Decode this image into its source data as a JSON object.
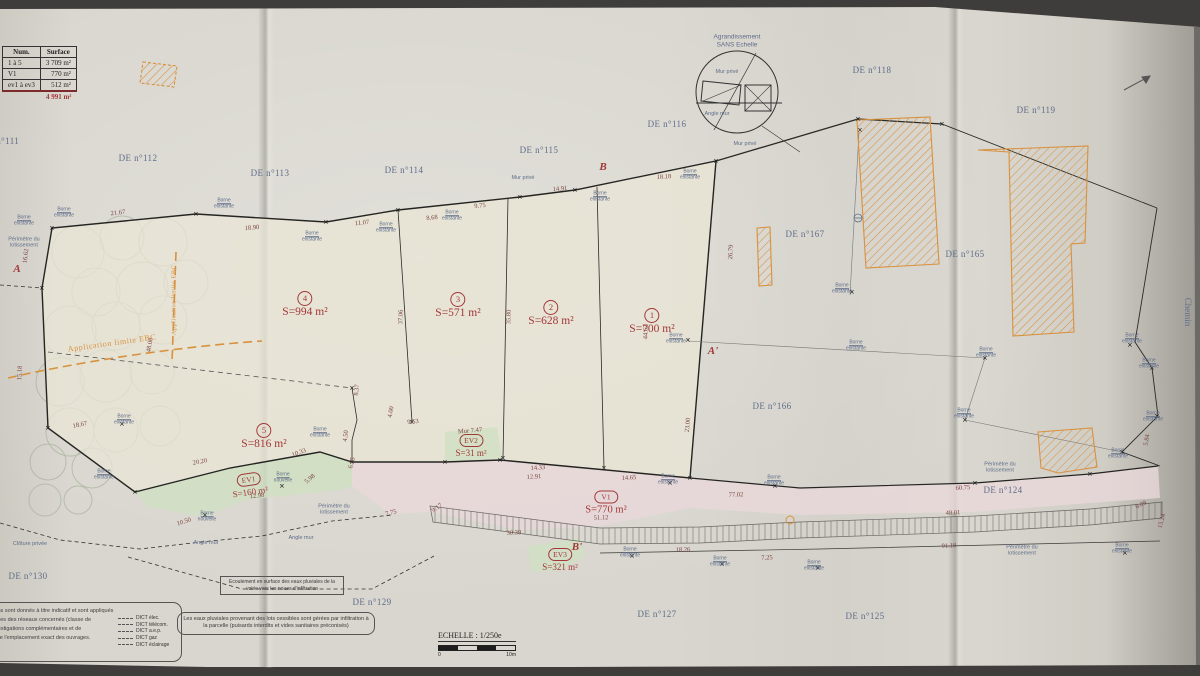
{
  "colors": {
    "paper": "#d6d4cc",
    "line": "#2a2a28",
    "blue": "#5f6d8a",
    "red": "#a33838",
    "orange": "#d8913f",
    "green_fill": "#cfe0c2",
    "pink_fill": "#e9d8da",
    "tree": "#9aa98e"
  },
  "summary_table": {
    "headers": [
      "Num.",
      "Surface"
    ],
    "rows": [
      [
        "1 à 5",
        "3 709 m²"
      ],
      [
        "V1",
        "770 m²"
      ],
      [
        "ev1 à ev3",
        "512 m²"
      ]
    ],
    "total": "4 991 m²"
  },
  "detail_circle": {
    "line1": "Agrandissement",
    "line2": "SANS Echelle"
  },
  "scale": {
    "label": "ECHELLE : 1/250e",
    "start": "0",
    "end": "10m"
  },
  "notes": {
    "flow": "Ecoulement en surface des eaux pluviales de la voirie vers les noues d'infiltration",
    "rain": "Les eaux pluviales provenant des lots cessibles sont gérées par infiltration à la parcelle (puisards interdits et vides sanitaires préconisés)",
    "left_paragraph": [
      "réseaux souterrains sont donnés à titre indicatif et sont appliqués",
      "les concessionnaires des réseaux concernés (classe de",
      "de réaliser les investigations complémentaires et de",
      "afin de s'assurer de l'emplacement exact des ouvrages."
    ],
    "dict_items": [
      "DICT élec.",
      "DICT télécom.",
      "DICT a.e.p.",
      "DICT gaz",
      "DICT éclairage"
    ]
  },
  "labels": {
    "parcels": [
      {
        "t": "DE n°111",
        "x": 0,
        "y": 141
      },
      {
        "t": "DE n°112",
        "x": 138,
        "y": 158
      },
      {
        "t": "DE n°113",
        "x": 270,
        "y": 173
      },
      {
        "t": "DE n°114",
        "x": 404,
        "y": 170
      },
      {
        "t": "DE n°115",
        "x": 539,
        "y": 150
      },
      {
        "t": "DE n°116",
        "x": 667,
        "y": 124
      },
      {
        "t": "DE n°118",
        "x": 872,
        "y": 70
      },
      {
        "t": "DE n°119",
        "x": 1036,
        "y": 110
      },
      {
        "t": "DE n°167",
        "x": 805,
        "y": 234
      },
      {
        "t": "DE n°165",
        "x": 965,
        "y": 254
      },
      {
        "t": "DE n°166",
        "x": 772,
        "y": 406
      },
      {
        "t": "DE n°124",
        "x": 1003,
        "y": 490
      },
      {
        "t": "DE n°125",
        "x": 865,
        "y": 616
      },
      {
        "t": "DE n°127",
        "x": 657,
        "y": 614
      },
      {
        "t": "DE n°129",
        "x": 372,
        "y": 602
      },
      {
        "t": "DE n°130",
        "x": 28,
        "y": 576
      }
    ],
    "lots": [
      {
        "id": "4",
        "area": "S=994 m²",
        "x": 305,
        "y": 303,
        "shape": "circle",
        "cls": ""
      },
      {
        "id": "3",
        "area": "S=571 m²",
        "x": 458,
        "y": 304,
        "shape": "circle",
        "cls": ""
      },
      {
        "id": "2",
        "area": "S=628 m²",
        "x": 551,
        "y": 312,
        "shape": "circle",
        "cls": ""
      },
      {
        "id": "1",
        "area": "S=700 m²",
        "x": 652,
        "y": 320,
        "shape": "circle",
        "cls": ""
      },
      {
        "id": "5",
        "area": "S=816 m²",
        "x": 264,
        "y": 435,
        "shape": "circle",
        "cls": ""
      },
      {
        "id": "V1",
        "area": "S=770 m²",
        "x": 606,
        "y": 501,
        "shape": "oval",
        "cls": "mid"
      },
      {
        "id": "EV2",
        "area": "S=31 m²",
        "x": 471,
        "y": 444,
        "shape": "oval",
        "cls": "small"
      },
      {
        "id": "EV1",
        "area": "S=160 m²",
        "x": 249,
        "y": 483,
        "shape": "oval",
        "cls": "small",
        "r": -8
      },
      {
        "id": "EV3",
        "area": "S=321 m²",
        "x": 560,
        "y": 558,
        "shape": "oval",
        "cls": "small"
      }
    ],
    "sections": [
      {
        "t": "A",
        "x": 17,
        "y": 269
      },
      {
        "t": "A'",
        "x": 713,
        "y": 351
      },
      {
        "t": "B",
        "x": 603,
        "y": 167
      },
      {
        "t": "B'",
        "x": 577,
        "y": 547
      }
    ],
    "measurements": [
      {
        "t": "21.67",
        "x": 118,
        "y": 213,
        "r": -7
      },
      {
        "t": "18.90",
        "x": 252,
        "y": 228,
        "r": -5
      },
      {
        "t": "11.07",
        "x": 362,
        "y": 223,
        "r": -6
      },
      {
        "t": "8.68",
        "x": 432,
        "y": 218,
        "r": -6
      },
      {
        "t": "9.75",
        "x": 480,
        "y": 206,
        "r": -6
      },
      {
        "t": "14.91",
        "x": 560,
        "y": 189,
        "r": -5
      },
      {
        "t": "18.18",
        "x": 664,
        "y": 177,
        "r": -3
      },
      {
        "t": "16.62",
        "x": 26,
        "y": 256,
        "r": -83
      },
      {
        "t": "15.18",
        "x": 20,
        "y": 373,
        "r": -87
      },
      {
        "t": "48.08",
        "x": 150,
        "y": 345,
        "r": -80
      },
      {
        "t": "18.67",
        "x": 80,
        "y": 425,
        "r": -12
      },
      {
        "t": "20.20",
        "x": 200,
        "y": 462,
        "r": -10
      },
      {
        "t": "10.50",
        "x": 184,
        "y": 522,
        "r": -18
      },
      {
        "t": "10.33",
        "x": 299,
        "y": 453,
        "r": -20
      },
      {
        "t": "12.98",
        "x": 257,
        "y": 496,
        "r": -6
      },
      {
        "t": "5.98",
        "x": 310,
        "y": 479,
        "r": -40
      },
      {
        "t": "6.55",
        "x": 352,
        "y": 463,
        "r": -75
      },
      {
        "t": "4.50",
        "x": 346,
        "y": 436,
        "r": -83
      },
      {
        "t": "8.37",
        "x": 357,
        "y": 390,
        "r": -85
      },
      {
        "t": "4.00",
        "x": 391,
        "y": 412,
        "r": -80
      },
      {
        "t": "9.53",
        "x": 413,
        "y": 422,
        "r": -6
      },
      {
        "t": "Mur 7.47",
        "x": 470,
        "y": 431,
        "r": -5
      },
      {
        "t": "14.33",
        "x": 538,
        "y": 468,
        "r": -4
      },
      {
        "t": "12.91",
        "x": 534,
        "y": 477,
        "r": -4
      },
      {
        "t": "14.65",
        "x": 629,
        "y": 478,
        "r": -3
      },
      {
        "t": "23.00",
        "x": 688,
        "y": 425,
        "r": -85
      },
      {
        "t": "44.62",
        "x": 646,
        "y": 332,
        "r": -88
      },
      {
        "t": "35.80",
        "x": 509,
        "y": 317,
        "r": -88
      },
      {
        "t": "37.06",
        "x": 401,
        "y": 317,
        "r": -88
      },
      {
        "t": "26.79",
        "x": 731,
        "y": 252,
        "r": -87
      },
      {
        "t": "51.12",
        "x": 601,
        "y": 518,
        "r": -2
      },
      {
        "t": "30.39",
        "x": 514,
        "y": 533,
        "r": -4
      },
      {
        "t": "7.75",
        "x": 391,
        "y": 513,
        "r": -14
      },
      {
        "t": "9.17",
        "x": 437,
        "y": 508,
        "r": -35
      },
      {
        "t": "77.02",
        "x": 736,
        "y": 495,
        "r": -2
      },
      {
        "t": "60.75",
        "x": 963,
        "y": 488,
        "r": -4
      },
      {
        "t": "48.01",
        "x": 953,
        "y": 513,
        "r": -3
      },
      {
        "t": "91.18",
        "x": 949,
        "y": 546,
        "r": -3
      },
      {
        "t": "18.26",
        "x": 683,
        "y": 550,
        "r": -2
      },
      {
        "t": "7.25",
        "x": 767,
        "y": 558,
        "r": -2
      },
      {
        "t": "6.09",
        "x": 1141,
        "y": 505,
        "r": -25
      },
      {
        "t": "5.84",
        "x": 1147,
        "y": 440,
        "r": -80
      },
      {
        "t": "15.24",
        "x": 1162,
        "y": 521,
        "r": -75
      }
    ],
    "bornes": [
      {
        "t": "Borne existante",
        "x": 24,
        "y": 221
      },
      {
        "t": "Borne existante",
        "x": 64,
        "y": 213
      },
      {
        "t": "Borne existante",
        "x": 224,
        "y": 204
      },
      {
        "t": "Borne existante",
        "x": 312,
        "y": 237
      },
      {
        "t": "Borne existante",
        "x": 386,
        "y": 228
      },
      {
        "t": "Borne existante",
        "x": 452,
        "y": 216
      },
      {
        "t": "Borne existante",
        "x": 600,
        "y": 197
      },
      {
        "t": "Borne existante",
        "x": 690,
        "y": 175
      },
      {
        "t": "Borne existante",
        "x": 842,
        "y": 289
      },
      {
        "t": "Borne existante",
        "x": 856,
        "y": 346
      },
      {
        "t": "Borne existante",
        "x": 986,
        "y": 353
      },
      {
        "t": "Borne existante",
        "x": 964,
        "y": 414
      },
      {
        "t": "Borne existante",
        "x": 1132,
        "y": 339
      },
      {
        "t": "Borne existante",
        "x": 1149,
        "y": 364
      },
      {
        "t": "Borne existante",
        "x": 1153,
        "y": 417
      },
      {
        "t": "Borne existante",
        "x": 1118,
        "y": 454
      },
      {
        "t": "Borne existante",
        "x": 668,
        "y": 480
      },
      {
        "t": "Borne existante",
        "x": 774,
        "y": 481
      },
      {
        "t": "Borne existante",
        "x": 630,
        "y": 553
      },
      {
        "t": "Borne existante",
        "x": 720,
        "y": 562
      },
      {
        "t": "Borne existante",
        "x": 814,
        "y": 566
      },
      {
        "t": "Borne existante",
        "x": 1122,
        "y": 549
      },
      {
        "t": "Borne existante",
        "x": 124,
        "y": 420
      },
      {
        "t": "Borne existante",
        "x": 104,
        "y": 475
      },
      {
        "t": "Borne existante",
        "x": 320,
        "y": 433
      },
      {
        "t": "Borne existante",
        "x": 676,
        "y": 339
      },
      {
        "t": "Borne nouvelle",
        "x": 283,
        "y": 478
      },
      {
        "t": "Borne nouvelle",
        "x": 207,
        "y": 517
      }
    ],
    "misc": [
      {
        "t": "Application limite EBC",
        "x": 112,
        "y": 343,
        "r": -8,
        "cls": "ebc"
      },
      {
        "t": "Application limite EBC",
        "x": 174,
        "y": 300,
        "r": -90,
        "cls": "ebc-v"
      },
      {
        "t": "Chemin",
        "x": 1188,
        "y": 312,
        "r": 90,
        "cls": "blue9"
      },
      {
        "t": "Mur privé",
        "x": 523,
        "y": 178,
        "r": 0,
        "cls": "tiny-blue"
      },
      {
        "t": "Mur privé",
        "x": 745,
        "y": 144,
        "r": 0,
        "cls": "tiny-blue"
      },
      {
        "t": "Mur privé",
        "x": 727,
        "y": 72,
        "r": 0,
        "cls": "tiny-blue"
      },
      {
        "t": "Angle mur",
        "x": 717,
        "y": 114,
        "r": 0,
        "cls": "tiny-blue"
      },
      {
        "t": "Angle mur",
        "x": 206,
        "y": 543,
        "r": 0,
        "cls": "tiny-blue"
      },
      {
        "t": "Angle mur",
        "x": 301,
        "y": 538,
        "r": 0,
        "cls": "tiny-blue"
      },
      {
        "t": "Clôture privée",
        "x": 30,
        "y": 544,
        "r": 0,
        "cls": "tiny-blue"
      },
      {
        "t": "Périmètre du lotissement",
        "x": 24,
        "y": 243,
        "r": 0,
        "cls": "tiny-blue",
        "w": 42
      },
      {
        "t": "Périmètre du lotissement",
        "x": 334,
        "y": 510,
        "r": 0,
        "cls": "tiny-blue",
        "w": 46
      },
      {
        "t": "Périmètre du lotissement",
        "x": 1000,
        "y": 468,
        "r": 0,
        "cls": "tiny-blue",
        "w": 46
      },
      {
        "t": "Périmètre du lotissement",
        "x": 1022,
        "y": 551,
        "r": 0,
        "cls": "tiny-blue",
        "w": 46
      }
    ]
  },
  "borne_marks": [
    [
      42,
      288
    ],
    [
      52,
      228
    ],
    [
      196,
      214
    ],
    [
      326,
      222
    ],
    [
      398,
      210
    ],
    [
      520,
      197
    ],
    [
      575,
      190
    ],
    [
      716,
      161
    ],
    [
      858,
      119
    ],
    [
      942,
      124
    ],
    [
      688,
      340
    ],
    [
      690,
      478
    ],
    [
      852,
      292
    ],
    [
      860,
      130
    ],
    [
      985,
      358
    ],
    [
      965,
      420
    ],
    [
      1130,
      345
    ],
    [
      1152,
      368
    ],
    [
      1157,
      416
    ],
    [
      1122,
      452
    ],
    [
      670,
      483
    ],
    [
      775,
      486
    ],
    [
      975,
      483
    ],
    [
      1090,
      474
    ],
    [
      632,
      556
    ],
    [
      722,
      564
    ],
    [
      818,
      568
    ],
    [
      1125,
      553
    ],
    [
      135,
      492
    ],
    [
      205,
      515
    ],
    [
      282,
      486
    ],
    [
      352,
      462
    ],
    [
      445,
      462
    ],
    [
      500,
      460
    ],
    [
      48,
      428
    ],
    [
      122,
      424
    ],
    [
      412,
      422
    ],
    [
      503,
      458
    ],
    [
      604,
      468
    ],
    [
      352,
      388
    ]
  ]
}
